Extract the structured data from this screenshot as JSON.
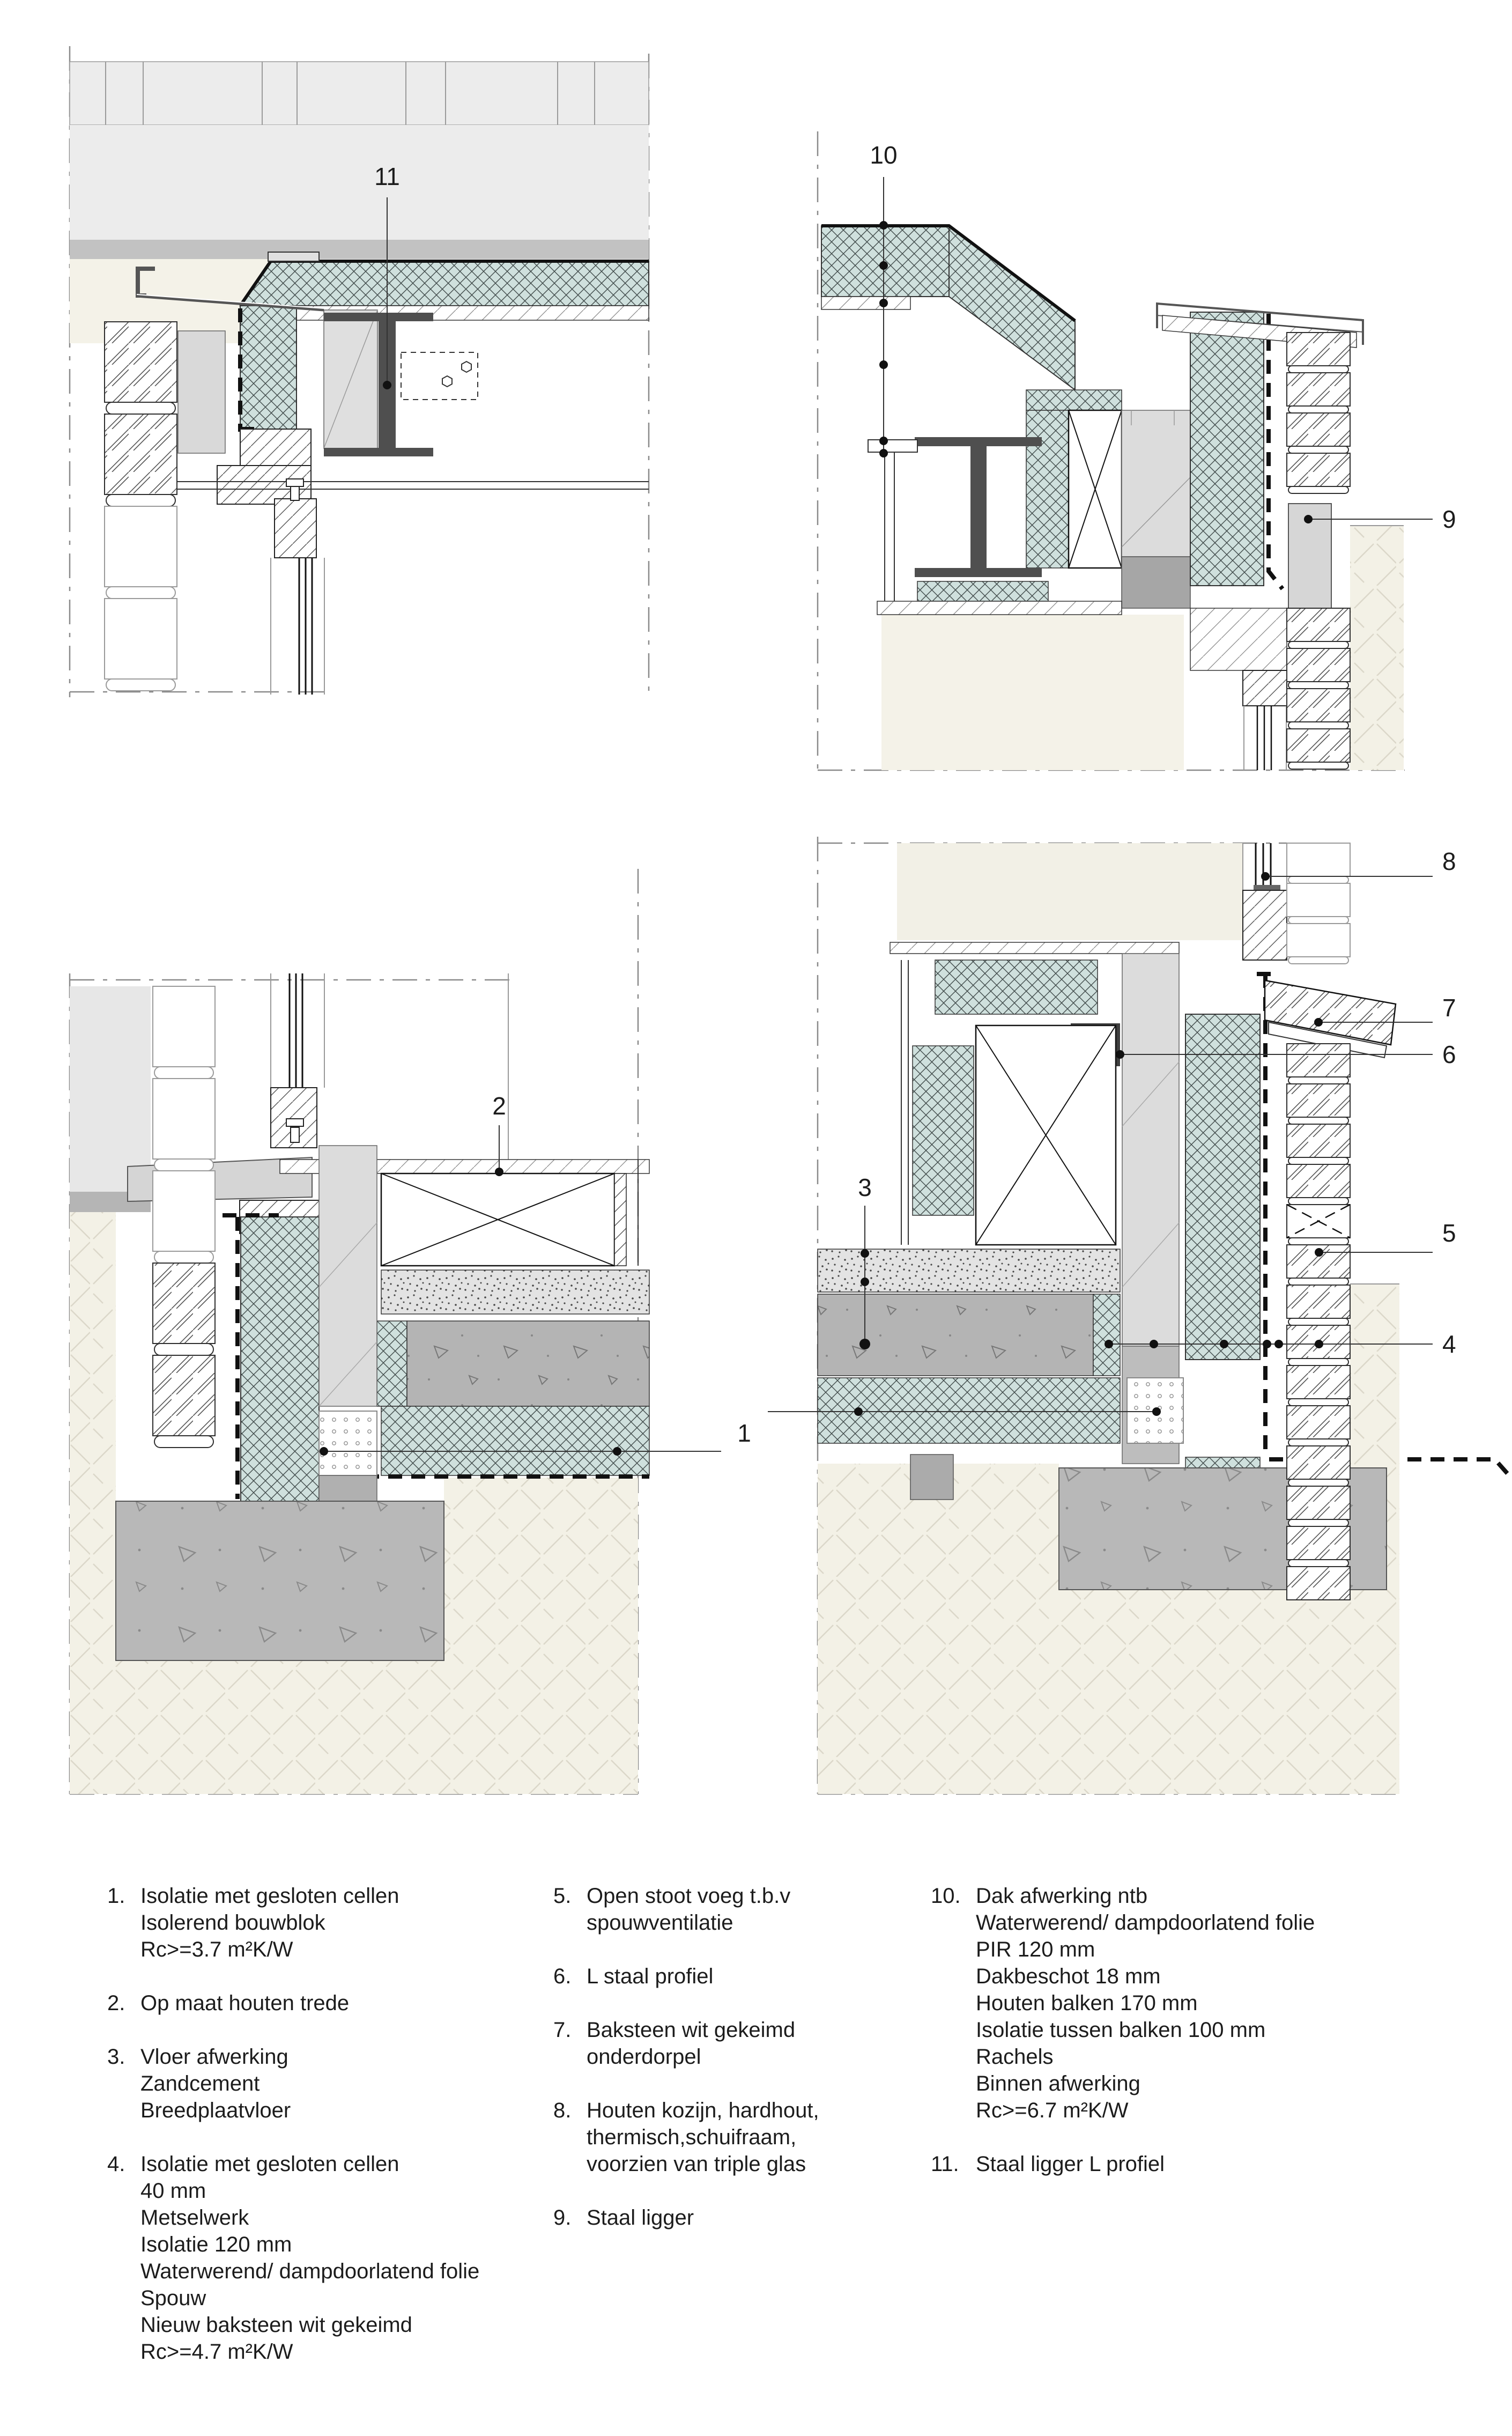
{
  "drawing": {
    "type": "architectural-section-details",
    "language": "nl",
    "details": [
      "roof-edge-existing-building",
      "roof-edge-new-extension-parapet",
      "foundation-existing-wall-step",
      "foundation-new-facade-wall"
    ]
  },
  "colors": {
    "insulation_teal": "#cfe0dd",
    "hatch_line": "#414b4b",
    "concrete_gray": "#b4b4b4",
    "foundation_gray": "#b8b8b8",
    "soil_cream": "#f3f1e6",
    "steel_dark": "#4f4f4f",
    "band_light": "#ececec",
    "band_mid": "#c2c2c2",
    "cream": "#f4f2e8",
    "block_gray": "#dcdcdc"
  },
  "callouts": {
    "c1": "1",
    "c2": "2",
    "c3": "3",
    "c4": "4",
    "c5": "5",
    "c6": "6",
    "c7": "7",
    "c8": "8",
    "c9": "9",
    "c10": "10",
    "c11": "11"
  },
  "legend": {
    "columns": [
      [
        {
          "num": "1.",
          "text": "Isolatie met gesloten cellen\nIsolerend bouwblok\nRc>=3.7 m²K/W"
        },
        {
          "num": "2.",
          "text": "Op maat houten trede"
        },
        {
          "num": "3.",
          "text": "Vloer afwerking\nZandcement\nBreedplaatvloer"
        },
        {
          "num": "4.",
          "text": "Isolatie met gesloten cellen\n40 mm\nMetselwerk\nIsolatie 120 mm\nWaterwerend/ dampdoorlatend folie\nSpouw\nNieuw baksteen wit gekeimd\nRc>=4.7 m²K/W"
        }
      ],
      [
        {
          "num": "5.",
          "text": "Open stoot voeg t.b.v\nspouwventilatie"
        },
        {
          "num": "6.",
          "text": "L staal profiel"
        },
        {
          "num": "7.",
          "text": "Baksteen wit gekeimd\nonderdorpel"
        },
        {
          "num": "8.",
          "text": "Houten kozijn, hardhout,\nthermisch,schuifraam,\nvoorzien van triple glas"
        },
        {
          "num": "9.",
          "text": "Staal ligger"
        }
      ],
      [
        {
          "num": "10.",
          "text": "Dak afwerking ntb\nWaterwerend/ dampdoorlatend folie\nPIR 120 mm\nDakbeschot 18 mm\nHouten balken 170 mm\nIsolatie tussen balken 100 mm\nRachels\nBinnen afwerking\nRc>=6.7 m²K/W"
        },
        {
          "num": "11.",
          "text": "Staal ligger L profiel"
        }
      ]
    ]
  }
}
